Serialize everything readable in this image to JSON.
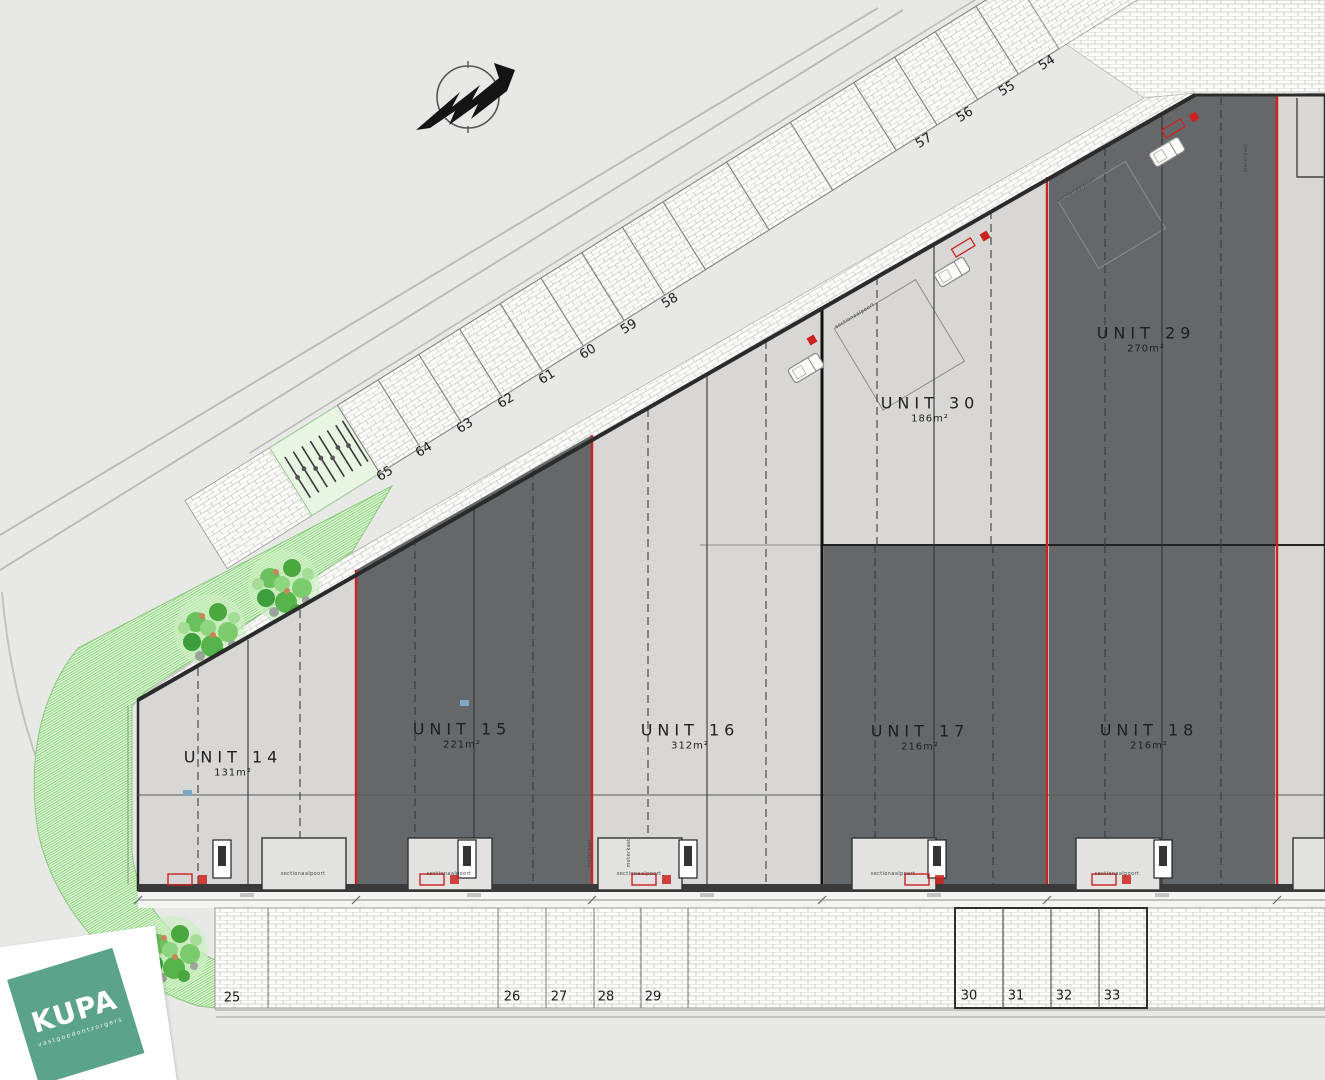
{
  "plan": {
    "units": [
      {
        "name": "UNIT 14",
        "area": "131m²"
      },
      {
        "name": "UNIT 15",
        "area": "221m²"
      },
      {
        "name": "UNIT 16",
        "area": "312m²"
      },
      {
        "name": "UNIT 17",
        "area": "216m²"
      },
      {
        "name": "UNIT 18",
        "area": "216m²"
      },
      {
        "name": "UNIT 30",
        "area": "186m²"
      },
      {
        "name": "UNIT 29",
        "area": "270m²"
      }
    ],
    "parking_diagonal": [
      "54",
      "55",
      "56",
      "57",
      "58",
      "59",
      "60",
      "61",
      "62",
      "63",
      "64",
      "65"
    ],
    "parking_bottom": [
      "25",
      "26",
      "27",
      "28",
      "29",
      "30",
      "31",
      "32",
      "33"
    ],
    "annotations": {
      "sectional_door": "sectionaalpoort",
      "meter_cabinet": "meterkast"
    }
  },
  "logo": {
    "brand": "KUPA",
    "tagline": "vastgoedontzorgers",
    "color": "#5ba38b"
  },
  "colors": {
    "road": "#e8e8e7",
    "unit_light": "#d8d7d5",
    "unit_dark": "#64686a",
    "boundary_red": "#cb2420",
    "wall_dark": "#2e2e2e",
    "grass": "#e4f6dc",
    "grass_line": "#86d478",
    "brick_line": "#c6c6c4"
  }
}
